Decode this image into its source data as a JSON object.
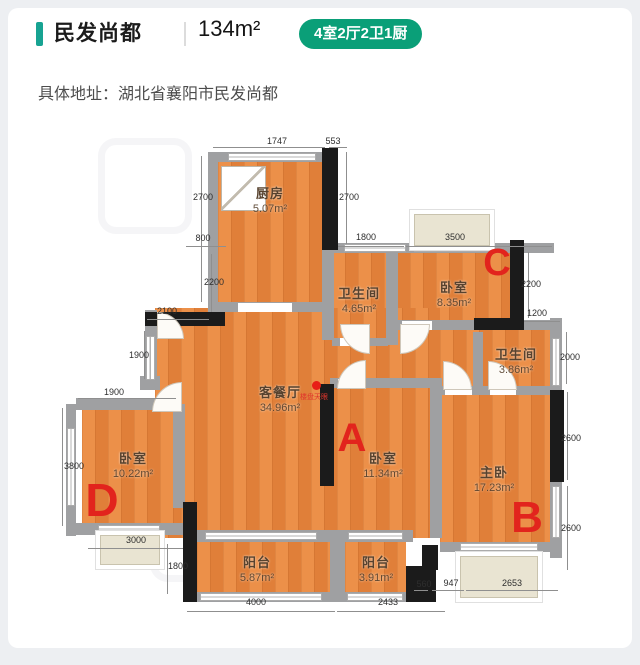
{
  "header": {
    "title": "民发尚都",
    "area": "134m²",
    "badge": "4室2厅2卫1厨",
    "accent_color": "#17a392",
    "badge_bg": "#0a9f78"
  },
  "address": {
    "text": "具体地址：湖北省襄阳市民发尚都"
  },
  "plan": {
    "floors": [
      [
        218,
        155,
        104,
        158
      ],
      [
        332,
        248,
        180,
        97
      ],
      [
        155,
        308,
        285,
        230
      ],
      [
        440,
        330,
        112,
        215
      ],
      [
        82,
        405,
        95,
        127
      ],
      [
        197,
        540,
        133,
        58
      ],
      [
        345,
        540,
        61,
        58
      ]
    ],
    "walls_gray": [
      [
        208,
        152,
        10,
        160
      ],
      [
        208,
        152,
        116,
        10
      ],
      [
        208,
        302,
        126,
        10
      ],
      [
        334,
        243,
        220,
        10
      ],
      [
        322,
        248,
        12,
        92
      ],
      [
        386,
        250,
        12,
        95
      ],
      [
        332,
        338,
        56,
        8
      ],
      [
        398,
        320,
        114,
        10
      ],
      [
        512,
        320,
        42,
        10
      ],
      [
        550,
        318,
        12,
        240
      ],
      [
        473,
        332,
        10,
        58
      ],
      [
        473,
        386,
        80,
        9
      ],
      [
        330,
        378,
        112,
        10
      ],
      [
        430,
        388,
        12,
        150
      ],
      [
        442,
        386,
        33,
        9
      ],
      [
        145,
        310,
        12,
        78
      ],
      [
        76,
        398,
        102,
        12
      ],
      [
        66,
        404,
        10,
        132
      ],
      [
        76,
        523,
        112,
        12
      ],
      [
        173,
        404,
        12,
        104
      ],
      [
        140,
        376,
        20,
        14
      ],
      [
        183,
        530,
        230,
        12
      ],
      [
        330,
        530,
        15,
        68
      ],
      [
        183,
        592,
        226,
        10
      ],
      [
        440,
        542,
        122,
        10
      ]
    ],
    "walls_black": [
      [
        322,
        148,
        16,
        102
      ],
      [
        510,
        240,
        14,
        90
      ],
      [
        474,
        318,
        40,
        12
      ],
      [
        145,
        312,
        80,
        14
      ],
      [
        320,
        384,
        14,
        102
      ],
      [
        550,
        390,
        14,
        92
      ],
      [
        183,
        502,
        14,
        100
      ],
      [
        422,
        545,
        16,
        25
      ],
      [
        406,
        566,
        30,
        36
      ]
    ],
    "gaps": [
      [
        238,
        303,
        54,
        9
      ],
      [
        340,
        338,
        28,
        8
      ],
      [
        402,
        321,
        30,
        9
      ],
      [
        338,
        379,
        28,
        9
      ],
      [
        445,
        387,
        27,
        8
      ],
      [
        490,
        387,
        26,
        8
      ]
    ],
    "windows": [
      [
        228,
        153,
        88,
        8
      ],
      [
        344,
        244,
        62,
        8
      ],
      [
        414,
        244,
        76,
        8
      ],
      [
        552,
        338,
        8,
        48
      ],
      [
        552,
        486,
        8,
        52
      ],
      [
        67,
        428,
        8,
        78
      ],
      [
        98,
        525,
        62,
        8
      ],
      [
        205,
        532,
        112,
        8
      ],
      [
        348,
        532,
        55,
        8
      ],
      [
        200,
        593,
        122,
        8
      ],
      [
        347,
        593,
        56,
        8
      ],
      [
        460,
        543,
        78,
        8
      ],
      [
        146,
        336,
        9,
        44
      ]
    ],
    "bays": [
      [
        414,
        214,
        76,
        32
      ],
      [
        460,
        556,
        78,
        42
      ],
      [
        100,
        535,
        60,
        30
      ]
    ],
    "doors": [
      {
        "b": [
          340,
          324,
          30
        ],
        "c": "bl"
      },
      {
        "b": [
          400,
          324,
          30
        ],
        "c": "br"
      },
      {
        "b": [
          337,
          360,
          29
        ],
        "c": "tl"
      },
      {
        "b": [
          443,
          361,
          29
        ],
        "c": "tr"
      },
      {
        "b": [
          488,
          361,
          29
        ],
        "c": "tr"
      },
      {
        "b": [
          152,
          382,
          30
        ],
        "c": "tl"
      },
      {
        "b": [
          157,
          312,
          27
        ],
        "c": "tr"
      }
    ],
    "kitchen_box": [
      221,
      166,
      45,
      45
    ],
    "rooms": [
      {
        "name": "厨房",
        "area": "5.07m²",
        "x": 270,
        "y": 199
      },
      {
        "name": "卫生间",
        "area": "4.65m²",
        "x": 359,
        "y": 299
      },
      {
        "name": "卧室",
        "area": "8.35m²",
        "x": 454,
        "y": 293
      },
      {
        "name": "卫生间",
        "area": "3.86m²",
        "x": 516,
        "y": 360
      },
      {
        "name": "客餐厅",
        "area": "34.96m²",
        "x": 280,
        "y": 398
      },
      {
        "name": "卧室",
        "area": "11.34m²",
        "x": 383,
        "y": 464
      },
      {
        "name": "主卧",
        "area": "17.23m²",
        "x": 494,
        "y": 478
      },
      {
        "name": "卧室",
        "area": "10.22m²",
        "x": 133,
        "y": 464
      },
      {
        "name": "阳台",
        "area": "5.87m²",
        "x": 257,
        "y": 568
      },
      {
        "name": "阳台",
        "area": "3.91m²",
        "x": 376,
        "y": 568
      }
    ],
    "dims": [
      {
        "t": "1747",
        "x": 277,
        "y": 141,
        "l": [
          213,
          147,
          112,
          1
        ]
      },
      {
        "t": "553",
        "x": 333,
        "y": 141,
        "l": [
          329,
          147,
          18,
          1
        ]
      },
      {
        "t": "2700",
        "x": 203,
        "y": 197,
        "l": [
          201,
          156,
          1,
          146
        ]
      },
      {
        "t": "2700",
        "x": 349,
        "y": 197,
        "l": [
          346,
          152,
          1,
          92
        ]
      },
      {
        "t": "800",
        "x": 203,
        "y": 238,
        "l": [
          186,
          246,
          40,
          1
        ]
      },
      {
        "t": "1800",
        "x": 366,
        "y": 237,
        "l": [
          338,
          246,
          66,
          1
        ]
      },
      {
        "t": "3500",
        "x": 455,
        "y": 237,
        "l": [
          406,
          246,
          146,
          1
        ]
      },
      {
        "t": "2200",
        "x": 531,
        "y": 284,
        "l": [
          528,
          252,
          1,
          66
        ]
      },
      {
        "t": "1200",
        "x": 537,
        "y": 313,
        "l": [
          524,
          321,
          36,
          1
        ]
      },
      {
        "t": "2000",
        "x": 570,
        "y": 357,
        "l": [
          566,
          332,
          1,
          52
        ]
      },
      {
        "t": "2600",
        "x": 571,
        "y": 438,
        "l": [
          567,
          392,
          1,
          88
        ]
      },
      {
        "t": "2600",
        "x": 571,
        "y": 528,
        "l": [
          567,
          486,
          1,
          84
        ]
      },
      {
        "t": "2200",
        "x": 214,
        "y": 282,
        "l": [
          211,
          254,
          1,
          58
        ]
      },
      {
        "t": "2100",
        "x": 167,
        "y": 311,
        "l": [
          147,
          319,
          62,
          1
        ]
      },
      {
        "t": "1900",
        "x": 139,
        "y": 355,
        "l": [
          144,
          331,
          1,
          48
        ]
      },
      {
        "t": "1900",
        "x": 114,
        "y": 392,
        "l": [
          78,
          398,
          98,
          1
        ]
      },
      {
        "t": "3800",
        "x": 74,
        "y": 466,
        "l": [
          62,
          408,
          1,
          118
        ]
      },
      {
        "t": "3000",
        "x": 136,
        "y": 540,
        "l": [
          88,
          548,
          95,
          1
        ]
      },
      {
        "t": "1800",
        "x": 178,
        "y": 566,
        "l": [
          167,
          544,
          1,
          50
        ]
      },
      {
        "t": "4000",
        "x": 256,
        "y": 602,
        "l": [
          187,
          611,
          148,
          1
        ]
      },
      {
        "t": "2433",
        "x": 388,
        "y": 602,
        "l": [
          337,
          611,
          108,
          1
        ]
      },
      {
        "t": "560",
        "x": 424,
        "y": 584,
        "l": [
          414,
          590,
          14,
          1
        ]
      },
      {
        "t": "947",
        "x": 451,
        "y": 583,
        "l": [
          432,
          590,
          32,
          1
        ]
      },
      {
        "t": "2653",
        "x": 512,
        "y": 583,
        "l": [
          466,
          590,
          92,
          1
        ]
      }
    ],
    "markers": [
      {
        "t": "A",
        "x": 352,
        "y": 438,
        "s": 40
      },
      {
        "t": "B",
        "x": 527,
        "y": 518,
        "s": 44
      },
      {
        "t": "C",
        "x": 497,
        "y": 263,
        "s": 38
      },
      {
        "t": "D",
        "x": 102,
        "y": 500,
        "s": 46
      }
    ],
    "dot": {
      "x": 316,
      "y": 385,
      "s": 9
    },
    "watermark": {
      "t": "楼盘天眼",
      "x": 314,
      "y": 397
    },
    "ghosts": [
      [
        98,
        138,
        80,
        82
      ],
      [
        150,
        478,
        92,
        90
      ]
    ]
  }
}
